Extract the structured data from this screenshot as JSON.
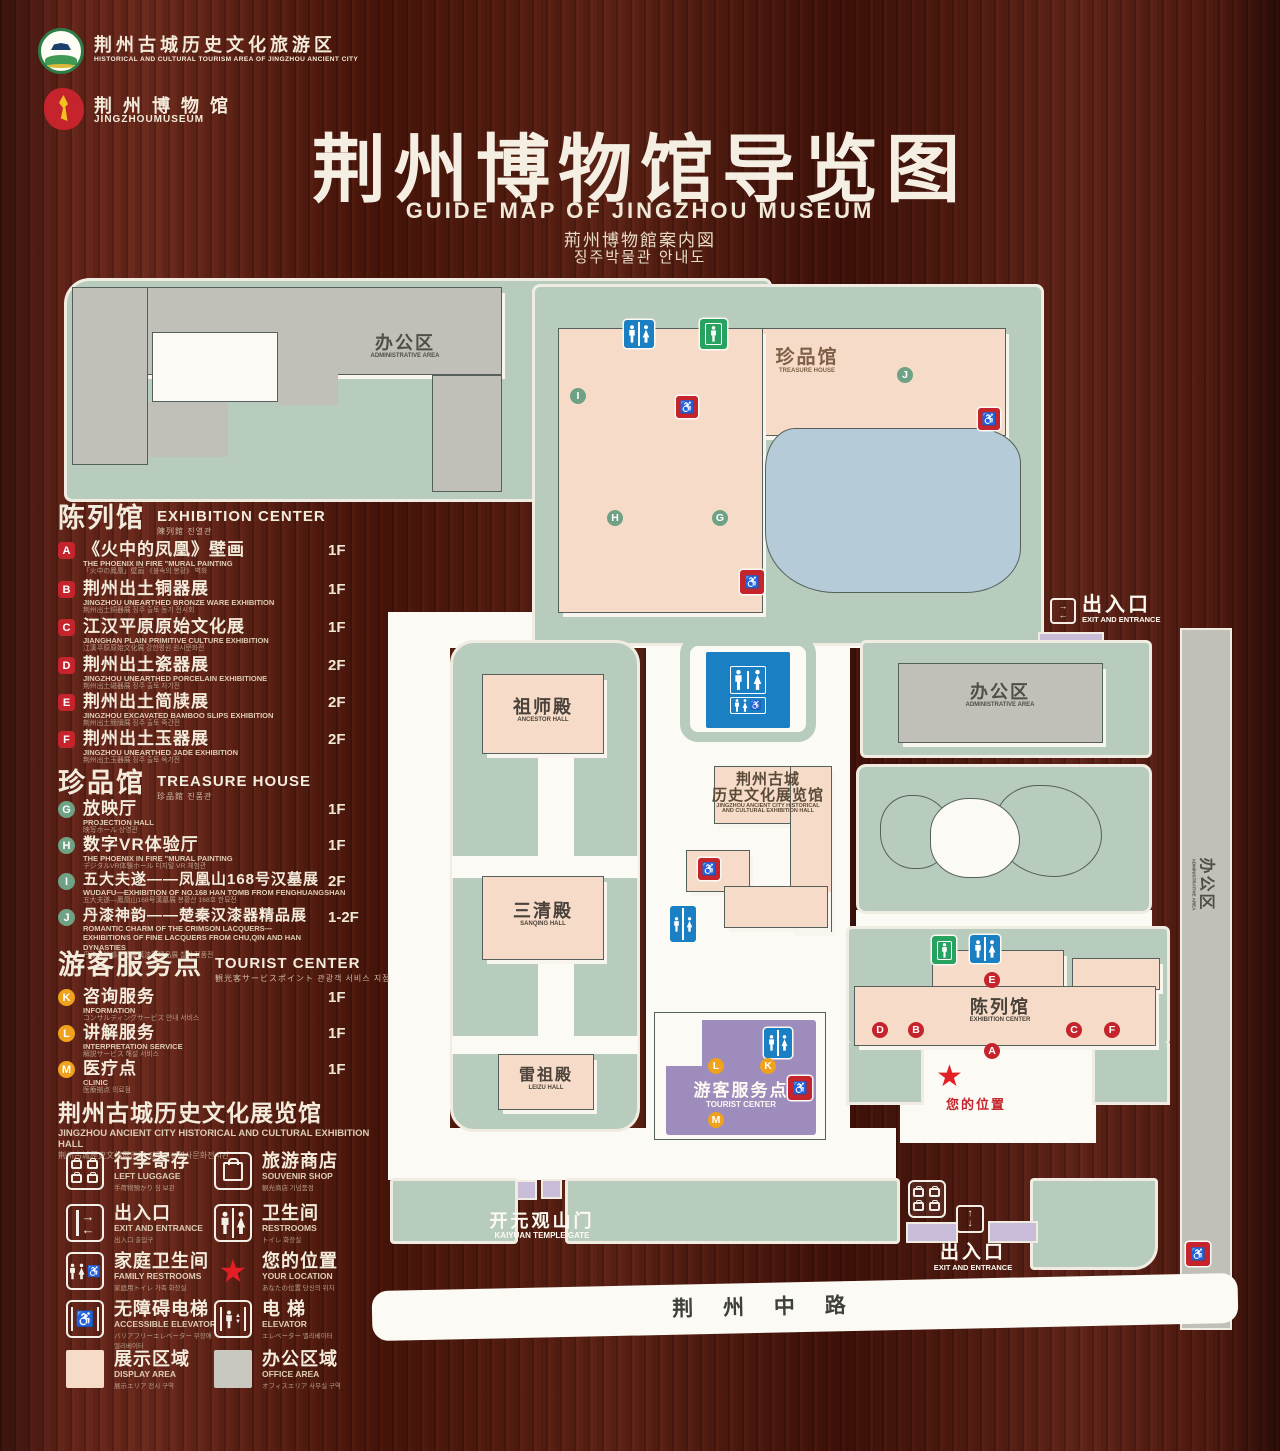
{
  "header": {
    "logo_tourism": {
      "zh": "荆州古城历史文化旅游区",
      "en": "HISTORICAL AND CULTURAL TOURISM AREA OF JINGZHOU ANCIENT CITY"
    },
    "logo_museum": {
      "zh": "荆 州 博 物 馆",
      "en": "JINGZHOUMUSEUM"
    },
    "title_zh": "荆州博物馆导览图",
    "title_en": "GUIDE MAP OF JINGZHOU MUSEUM",
    "title_ja": "荊州博物館案内図",
    "title_ko": "징주박물관 안내도"
  },
  "legend": {
    "exhibition": {
      "zh": "陈列馆",
      "en": "EXHIBITION CENTER",
      "sub": "陳列館  진열관",
      "items": [
        {
          "letter": "A",
          "zh": "《火中的凤凰》壁画",
          "en": "THE PHOENIX IN FIRE \"MURAL PAINTING",
          "jk": "「火中の鳳凰」壁画 《불속의 봉황》 벽화",
          "floor": "1F"
        },
        {
          "letter": "B",
          "zh": "荆州出土铜器展",
          "en": "JINGZHOU UNEARTHED BRONZE WARE EXHIBITION",
          "jk": "荆州出土銅器展  징주 출토 동기 전시회",
          "floor": "1F"
        },
        {
          "letter": "C",
          "zh": "江汉平原原始文化展",
          "en": "JIANGHAN PLAIN PRIMITIVE CULTURE EXHIBITION",
          "jk": "江漢平原原始文化展  강한평원 원시문화전",
          "floor": "1F"
        },
        {
          "letter": "D",
          "zh": "荆州出土瓷器展",
          "en": "JINGZHOU UNEARTHED PORCELAIN EXHIBITIONE",
          "jk": "荆州出土磁器展  징주 출토 자기전",
          "floor": "2F"
        },
        {
          "letter": "E",
          "zh": "荆州出土简牍展",
          "en": "JINGZHOU EXCAVATED BAMBOO SLIPS EXHIBITION",
          "jk": "荆州出土簡牘展  징주 출토 죽간전",
          "floor": "2F"
        },
        {
          "letter": "F",
          "zh": "荆州出土玉器展",
          "en": "JINGZHOU UNEARTHED JADE EXHIBITION",
          "jk": "荆州出土玉器展  징주 출토 옥기전",
          "floor": "2F"
        }
      ]
    },
    "treasure": {
      "zh": "珍品馆",
      "en": "TREASURE HOUSE",
      "sub": "珍品館  진품관",
      "items": [
        {
          "letter": "G",
          "zh": "放映厅",
          "en": "PROJECTION HALL",
          "jk": "映写ホール  상영관",
          "floor": "1F"
        },
        {
          "letter": "H",
          "zh": "数字VR体验厅",
          "en": "THE PHOENIX IN FIRE \"MURAL PAINTING",
          "jk": "デジタルVR体験ホール  디지털 VR 체험관",
          "floor": "1F"
        },
        {
          "letter": "I",
          "zh": "五大夫遂——凤凰山168号汉墓展",
          "en": "WUDAFU—EXHIBITION OF NO.168 HAN TOMB FROM FENGHUANGSHAN",
          "jk": "五大夫遂—鳳凰山168号漢墓展  봉황산 168호 한묘전",
          "floor": "2F"
        },
        {
          "letter": "J",
          "zh": "丹漆神韵——楚秦汉漆器精品展",
          "en": "ROMANTIC CHARM OF THE CRIMSON LACQUERS— EXHIBITIONS OF FINE LACQUERS FROM CHU,QIN AND HAN DYNASTIES",
          "jk": "丹漆の神韻—楚秦漢漆器精品展  칠기 정품전",
          "floor": "1-2F"
        }
      ]
    },
    "tourist": {
      "zh": "游客服务点",
      "en": "TOURIST CENTER",
      "sub": "観光客サービスポイント  관광객 서비스 지점",
      "items": [
        {
          "letter": "K",
          "zh": "咨询服务",
          "en": "INFORMATION",
          "jk": "コンサルティングサービス  안내 서비스",
          "floor": "1F"
        },
        {
          "letter": "L",
          "zh": "讲解服务",
          "en": "INTERPRETATION SERVICE",
          "jk": "解説サービス  해설 서비스",
          "floor": "1F"
        },
        {
          "letter": "M",
          "zh": "医疗点",
          "en": "CLINIC",
          "jk": "医療拠点  의료점",
          "floor": "1F"
        }
      ]
    },
    "hall_note": {
      "zh": "荆州古城历史文化展览馆",
      "en": "JINGZHOU ANCIENT CITY HISTORICAL AND CULTURAL EXHIBITION HALL",
      "jk": "荆州古城歴史文化展示館    징주고성역사문화전시관"
    },
    "facilities": [
      {
        "icon": "left-luggage-icon",
        "zh": "行李寄存",
        "en": "LEFT LUGGAGE",
        "jk": "手荷物預かり  짐 보관"
      },
      {
        "icon": "souvenir-shop-icon",
        "zh": "旅游商店",
        "en": "SOUVENIR SHOP",
        "jk": "観光商店  기념품점"
      },
      {
        "icon": "exit-entrance-icon",
        "zh": "出入口",
        "en": "EXIT AND ENTRANCE",
        "jk": "出入口  출입구"
      },
      {
        "icon": "restrooms-icon",
        "zh": "卫生间",
        "en": "RESTROOMS",
        "jk": "トイレ  화장실"
      },
      {
        "icon": "family-restrooms-icon",
        "zh": "家庭卫生间",
        "en": "FAMILY RESTROOMS",
        "jk": "家庭用トイレ  가족 화장실"
      },
      {
        "icon": "your-location-icon",
        "zh": "您的位置",
        "en": "YOUR LOCATION",
        "jk": "あなたの位置  당신의 위치"
      },
      {
        "icon": "accessible-elevator-icon",
        "zh": "无障碍电梯",
        "en": "ACCESSIBLE ELEVATOR",
        "jk": "バリアフリーエレベーター  무장애 엘리베이터"
      },
      {
        "icon": "elevator-icon",
        "zh": "电  梯",
        "en": "ELEVATOR",
        "jk": "エレベーター  엘리베이터"
      }
    ],
    "areas": [
      {
        "zh": "展示区域",
        "en": "DISPLAY AREA",
        "jk": "展示エリア  전시 구역",
        "color": "#f6dcc8"
      },
      {
        "zh": "办公区域",
        "en": "OFFICE AREA",
        "jk": "オフィスエリア  사무실 구역",
        "color": "#c9c8c0"
      }
    ]
  },
  "map": {
    "admin_tl": {
      "zh": "办公区",
      "en": "ADMINISTRATIVE AREA"
    },
    "treasure": {
      "zh": "珍品馆",
      "en": "TREASURE HOUSE"
    },
    "exit_right": {
      "zh": "出入口",
      "en": "EXIT AND ENTRANCE"
    },
    "admin_right": {
      "zh": "办公区",
      "en": "ADMINISTRATIVE AREA"
    },
    "admin_strip": {
      "zh": "办公区",
      "en": "ADMINISTRATIVE AREA"
    },
    "ancestor_hall": {
      "zh": "祖师殿",
      "en": "ANCESTOR HALL"
    },
    "sanqing_hall": {
      "zh": "三清殿",
      "en": "SANQING HALL"
    },
    "leizu_hall": {
      "zh": "雷祖殿",
      "en": "LEIZU HALL"
    },
    "exhibition_hall": {
      "zh1": "荆州古城",
      "zh2": "历史文化展览馆",
      "en1": "JINGZHOU ANCIENT CITY HISTORICAL",
      "en2": "AND CULTURAL EXHIBITION HALL"
    },
    "tourist_center": {
      "zh": "游客服务点",
      "en": "TOURIST CENTER"
    },
    "exhibition_center": {
      "zh": "陈列馆",
      "en": "EXHIBITION CENTER"
    },
    "your_location": "您的位置",
    "kaiyuan_gate": {
      "zh": "开元观山门",
      "en": "KAIYUAN TEMPLE GATE"
    },
    "exit_bottom": {
      "zh": "出入口",
      "en": "EXIT AND ENTRANCE"
    },
    "road": "荆 州 中 路",
    "markers": {
      "a": "A",
      "b": "B",
      "c": "C",
      "d": "D",
      "e": "E",
      "f": "F",
      "g": "G",
      "h": "H",
      "i": "I",
      "j": "J",
      "k": "K",
      "l": "L",
      "m": "M"
    }
  },
  "colors": {
    "sage": "#b7ccbd",
    "pink": "#f6dcc8",
    "gray": "#c1c0b8",
    "pond": "#b6cbd8",
    "purple": "#9d8cbc",
    "gate": "#c9bcd9",
    "marker_red": "#c5242c",
    "marker_green": "#6fa284",
    "marker_orange": "#f0a21c",
    "restroom_blue": "#1b7fc4",
    "elevator_green": "#27a35f",
    "wood": "#4c1a10"
  }
}
